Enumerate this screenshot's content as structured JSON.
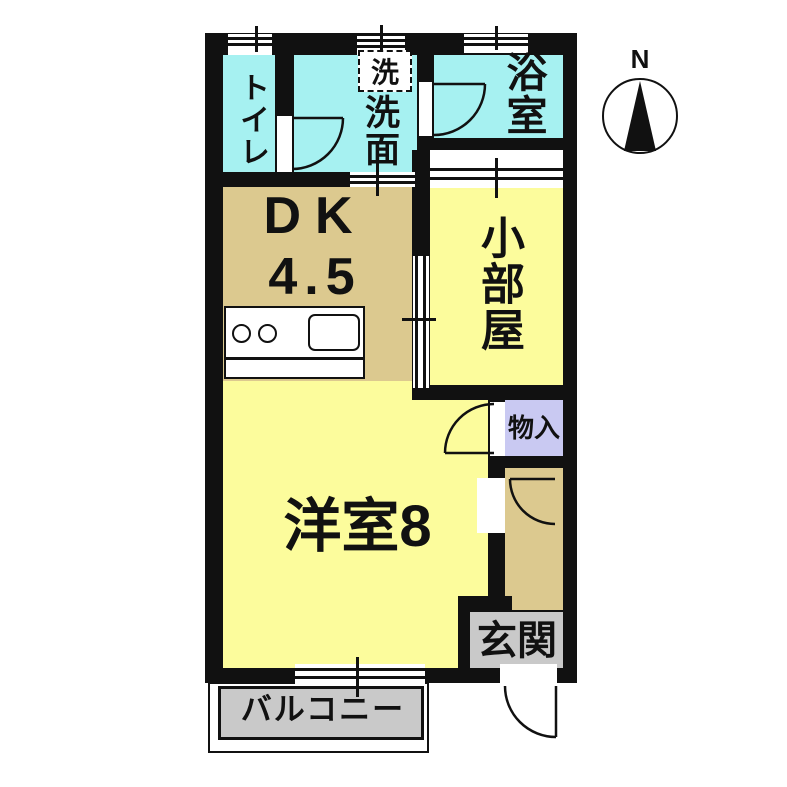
{
  "compass": {
    "label": "N"
  },
  "rooms": {
    "toilet": {
      "label": "トイレ"
    },
    "washroom": {
      "label": "洗面"
    },
    "washer_box": {
      "label": "洗"
    },
    "bathroom": {
      "label": "浴室"
    },
    "dk": {
      "label": "DK",
      "size": "4.5"
    },
    "small_room": {
      "label": "小部屋"
    },
    "storage": {
      "label": "物入"
    },
    "western_room": {
      "label": "洋室8"
    },
    "entrance": {
      "label": "玄関"
    },
    "balcony": {
      "label": "バルコニー"
    }
  },
  "colors": {
    "wet_area": "#a6f1f1",
    "kitchen_hall": "#dcc98f",
    "living": "#fcfc9c",
    "storage": "#c9c9f2",
    "entrance_balcony": "#c9c9c9",
    "wall": "#111111"
  }
}
